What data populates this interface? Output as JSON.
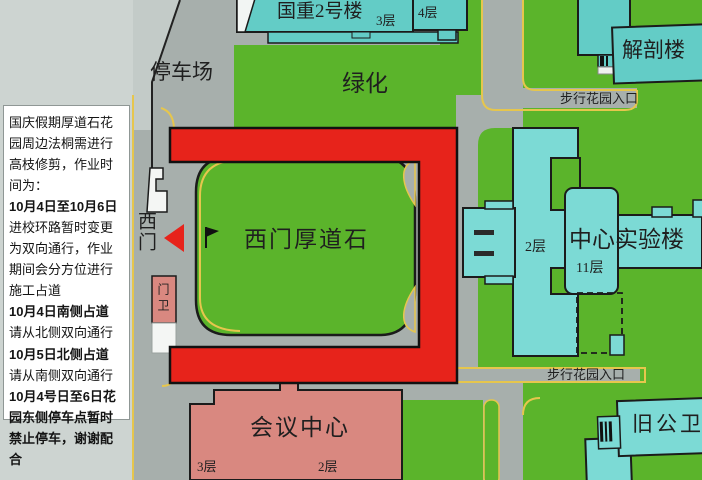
{
  "notice_panel": {
    "paragraphs": [
      {
        "text": "国庆假期厚道石花园周边法桐需进行高枝修剪，作业时间为：",
        "bold": false
      },
      {
        "text": "10月4日至10月6日",
        "bold": true
      },
      {
        "text": "进校环路暂时变更为双向通行，作业期间会分方位进行施工占道",
        "bold": false
      },
      {
        "text": "10月4日南侧占道",
        "bold": true
      },
      {
        "text": "请从北侧双向通行",
        "bold": false
      },
      {
        "text": "10月5日北侧占道",
        "bold": true
      },
      {
        "text": "请从南侧双向通行",
        "bold": false
      },
      {
        "text": "10月4号日至6日花园东侧停车点暂时禁止停车，谢谢配合",
        "bold": true
      }
    ]
  },
  "map": {
    "labels": {
      "parking": "停车场",
      "greenery": "绿化",
      "guozhong_building": "国重2号楼",
      "guozhong_floor": "3层",
      "annex_floor": "4层",
      "anatomy_building": "解剖楼",
      "walk_garden_entrance_top": "步行花园入口",
      "walk_garden_entrance_bottom": "步行花园入口",
      "central_lab_building": "中心实验楼",
      "central_lab_wing_floor": "2层",
      "central_lab_tower_floor": "11层",
      "west_gate": "西门",
      "gate_guard": "门卫",
      "west_gate_stone": "西门厚道石",
      "conference_center": "会议中心",
      "conference_floor_left": "3层",
      "conference_floor_right": "2层",
      "old_public_health_building": "旧公卫楼"
    },
    "colors": {
      "lawn_green": "#5bb42b",
      "road_gray": "#a7afac",
      "light_road_gray": "#cdd4d1",
      "building_teal": "#63ccc6",
      "lab_teal": "#7cdad5",
      "closure_red": "#e7231b",
      "building_pink": "#d98880",
      "curb_yellow": "#e6c64d"
    }
  }
}
